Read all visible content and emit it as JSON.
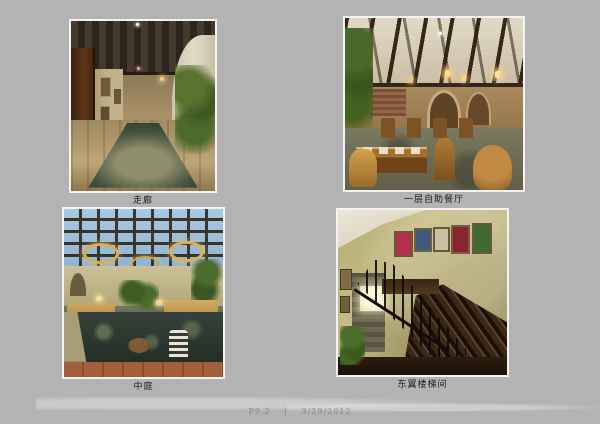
{
  "page": {
    "background_color": "#b3b3b5",
    "photo_border_color": "#f4f3f1",
    "caption_color": "#1c1c1c"
  },
  "figures": [
    {
      "name": "corridor",
      "caption": "走廊",
      "palette": [
        "#3a3024",
        "#c2b28c",
        "#b49a6c",
        "#28342e",
        "#4c6a2a"
      ]
    },
    {
      "name": "buffet-restaurant",
      "caption": "一层自助餐厅",
      "palette": [
        "#d8d0ba",
        "#3a2c1e",
        "#a98c62",
        "#c99c48",
        "#6e6e56"
      ]
    },
    {
      "name": "atrium",
      "caption": "中庭",
      "palette": [
        "#a9c9e2",
        "#d8ac54",
        "#c4b890",
        "#2c382e",
        "#9a5c38"
      ]
    },
    {
      "name": "stairwell",
      "caption": "东翼楼梯间",
      "palette": [
        "#c6bc86",
        "#3a2815",
        "#ece6d6",
        "#fcf6d8",
        "#4c6e2c"
      ]
    }
  ],
  "footer": {
    "page_label": "P9.2",
    "separator": "|",
    "date": "3/29/2012"
  }
}
